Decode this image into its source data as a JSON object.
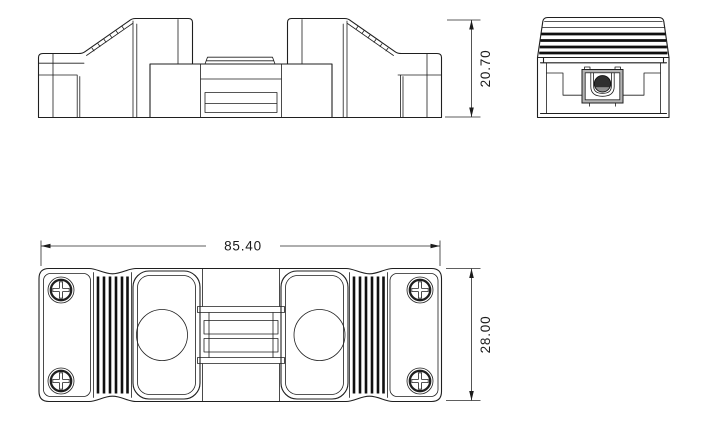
{
  "page": {
    "background": "#ffffff",
    "line_color": "#1f1f1f"
  },
  "drawing": {
    "dimensions": {
      "front_height": {
        "value": "20.70",
        "orientation": "vertical"
      },
      "plan_width": {
        "value": "85.40",
        "orientation": "horizontal"
      },
      "plan_depth": {
        "value": "28.00",
        "orientation": "vertical"
      }
    }
  }
}
